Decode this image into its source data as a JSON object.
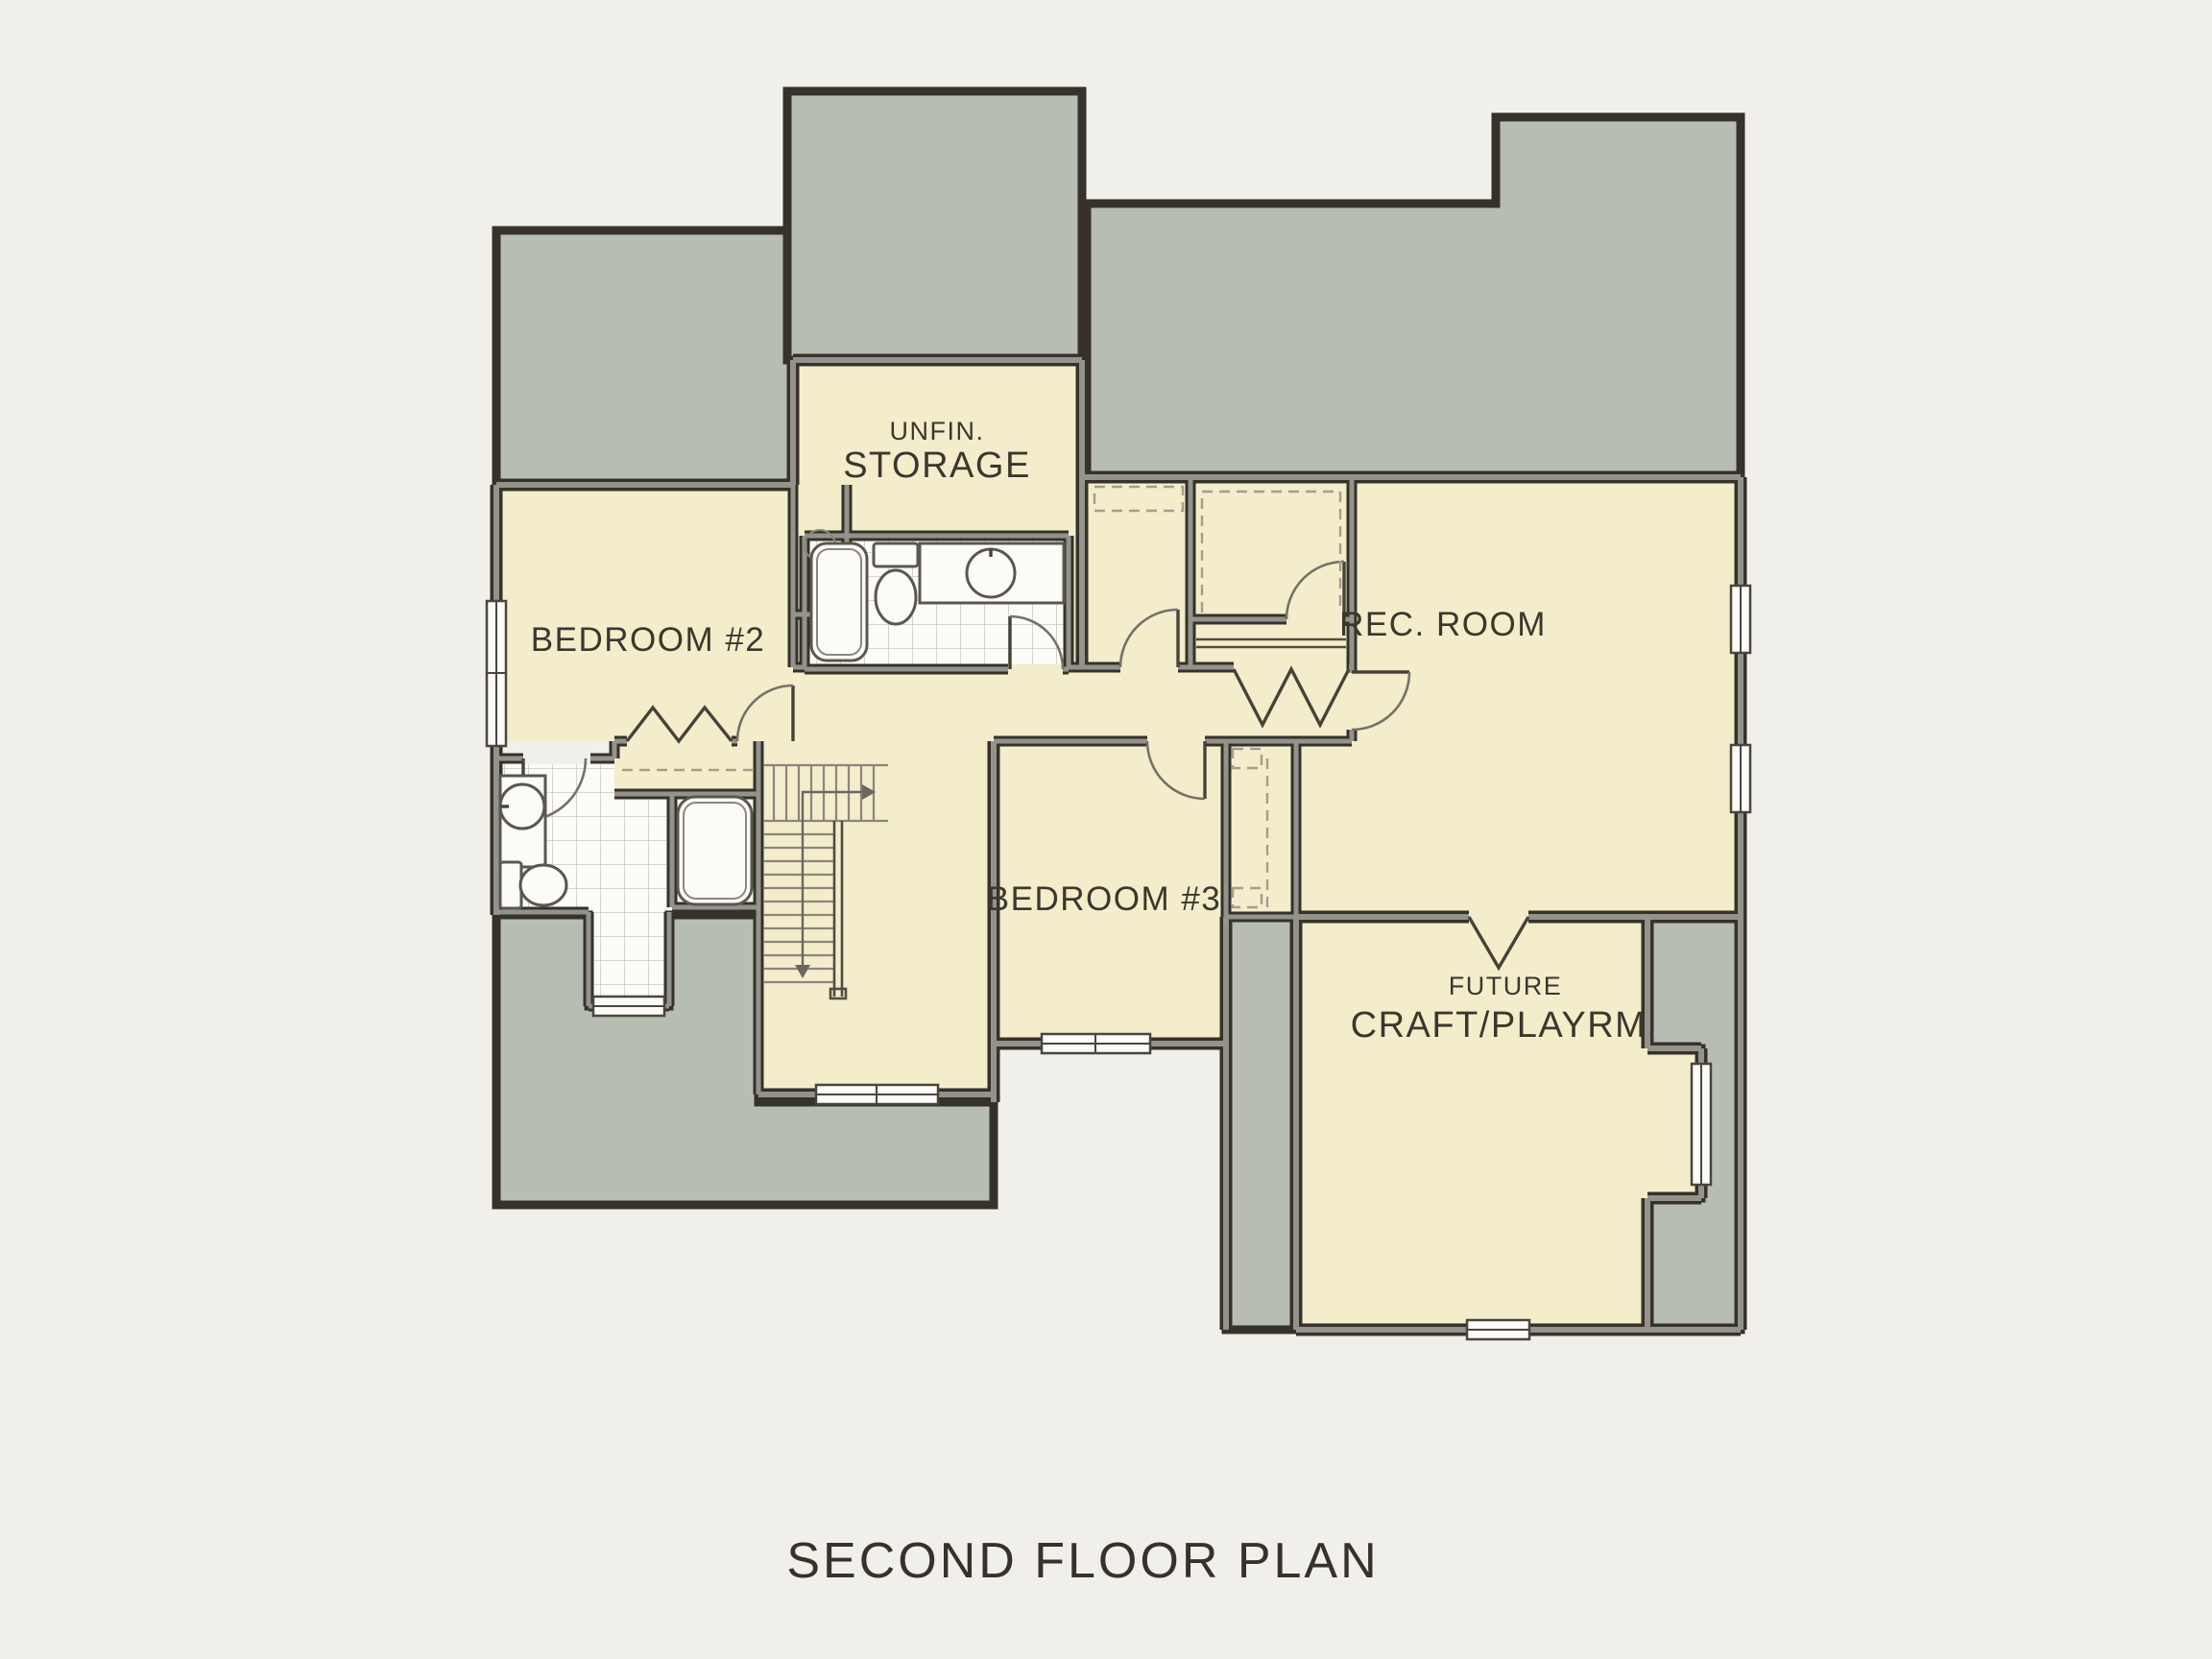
{
  "title": "SECOND FLOOR PLAN",
  "rooms": {
    "storage": {
      "line1": "UNFIN.",
      "line2": "STORAGE"
    },
    "bedroom2": {
      "label": "BEDROOM #2"
    },
    "rec_room": {
      "label": "REC. ROOM"
    },
    "bedroom3": {
      "label": "BEDROOM #3"
    },
    "craft": {
      "line1": "FUTURE",
      "line2": "CRAFT/PLAYRM."
    }
  },
  "colors": {
    "bg": "#f0efea",
    "cream": "#f3edcb",
    "attic": "#b8bdb2",
    "wall": "#36322a",
    "ink": "#3b372e"
  }
}
